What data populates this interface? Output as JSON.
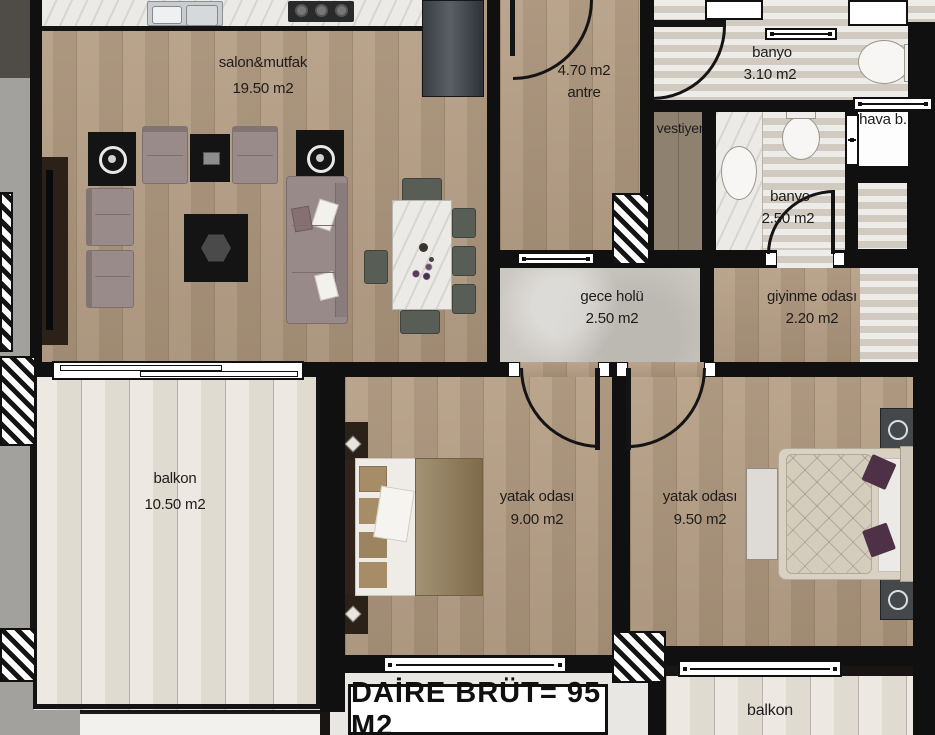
{
  "meta": {
    "type": "apartment floor plan",
    "colors": {
      "wall": "#101010",
      "wood_floor": "#b29a80",
      "balcony_floor": "#e7e2d8",
      "hall_stone": "#cbc8c2",
      "bath_tile": "#ded9d1",
      "label_text": "#1e1c1a"
    }
  },
  "rooms": {
    "salon": {
      "name": "salon&mutfak",
      "area": "19.50 m2"
    },
    "antre": {
      "area": "4.70 m2",
      "name": "antre"
    },
    "banyo1": {
      "name": "banyo",
      "area": "3.10 m2"
    },
    "hava": {
      "name": "hava b."
    },
    "vestiyer": {
      "name": "vestiyer"
    },
    "banyo2": {
      "name": "banyo",
      "area": "2.50 m2"
    },
    "gece_holu": {
      "name": "gece holü",
      "area": "2.50 m2"
    },
    "giyinme": {
      "name": "giyinme odası",
      "area": "2.20 m2"
    },
    "balkon": {
      "name": "balkon",
      "area": "10.50 m2"
    },
    "yatak1": {
      "name": "yatak odası",
      "area": "9.00 m2"
    },
    "yatak2": {
      "name": "yatak odası",
      "area": "9.50 m2"
    },
    "balkon2": {
      "name": "balkon"
    }
  },
  "footer": {
    "total_label": "DAİRE BRÜT= 95 M2"
  }
}
